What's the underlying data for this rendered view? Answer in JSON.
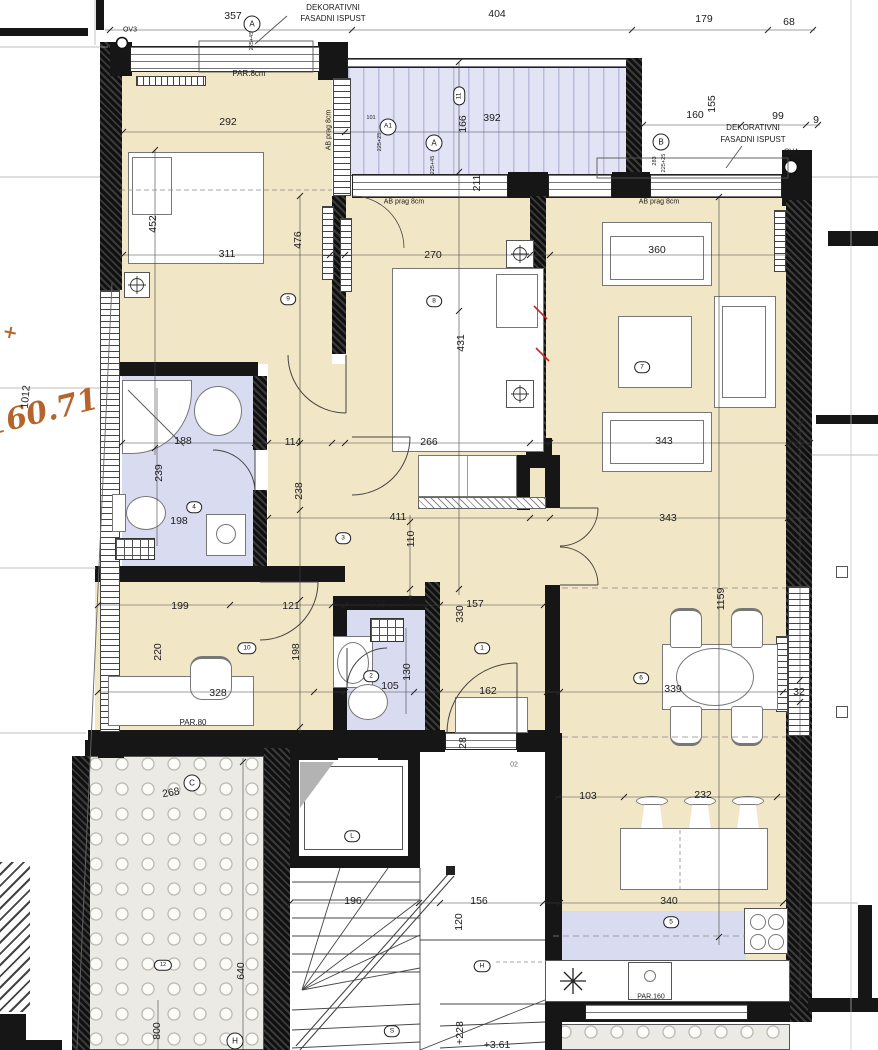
{
  "drawing_type": "architectural floor plan (apartment with terraces, stairs and elevator)",
  "colors": {
    "floor_cream": "#f1e6c6",
    "wet_room_blue": "#d9dbf1",
    "terrace_stripe": "#e2e3f4",
    "wall_black": "#161616",
    "survey_orange": "#b5652c",
    "red_mark": "#cc2222"
  },
  "t": {
    "d357": "357",
    "d404": "404",
    "d179": "179",
    "d68": "68",
    "dek1": "DEKORATIVNI",
    "dek2": "FASADNI ISPUST",
    "ov3": "OV3",
    "ov4": "OV4",
    "par8": "PAR.8cm",
    "abprag": "AB prag 8cm",
    "d292": "292",
    "d392": "392",
    "d166": "166",
    "d160": "160",
    "d155": "155",
    "d99": "99",
    "d9": "9",
    "d211": "211",
    "mA": "A",
    "mA1": "A1",
    "mB": "B",
    "mC": "C",
    "mH": "H",
    "t101": "101",
    "t22525": "225+25",
    "t22545": "225+45",
    "t283": "283",
    "d452": "452",
    "d311": "311",
    "d476": "476",
    "d270": "270",
    "d431": "431",
    "d360": "360",
    "d343": "343",
    "d33": "33",
    "d188": "188",
    "d239": "239",
    "d114": "114",
    "d198": "198",
    "d238": "238",
    "d266": "266",
    "d411": "411",
    "d110": "110",
    "d1159": "1159",
    "d199": "199",
    "d220": "220",
    "d121": "121",
    "d328": "328",
    "par80": "PAR.80",
    "d125": "125",
    "d69": "69",
    "d105": "105",
    "d130": "130",
    "d157": "157",
    "d330": "330",
    "d162": "162",
    "d28": "28",
    "d339": "339",
    "d32": "32",
    "d103": "103",
    "d232": "232",
    "d340": "340",
    "par160": "PAR.160",
    "d268": "268",
    "d196": "196",
    "d156": "156",
    "d120": "120",
    "d640": "640",
    "d800": "800",
    "d228": "+228",
    "d361": "+3.61",
    "d02": "02",
    "orange_level": "160.71",
    "orange_plus": "+",
    "d1012": "1012",
    "r1": "1",
    "r2": "2",
    "r3": "3",
    "r4": "4",
    "r5": "5",
    "r6": "6",
    "r7": "7",
    "r8": "8",
    "r9": "9",
    "r10": "10",
    "r11": "11",
    "r12": "12",
    "rL": "L",
    "rS": "S",
    "rH": "H"
  }
}
